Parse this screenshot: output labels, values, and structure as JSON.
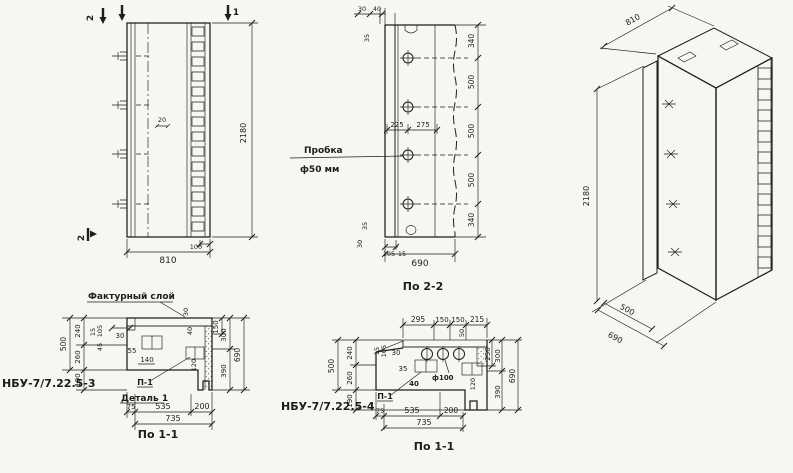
{
  "canvas": {
    "bg": "#f7f6f1",
    "ink": "#1d1d1d"
  },
  "elevation": {
    "mark_top_left": "2",
    "mark_top_right": "1",
    "mark_bottom_left": "2",
    "dim_hook": "20",
    "dim_height": "2180",
    "dim_strip": "100",
    "dim_width": "810"
  },
  "section22": {
    "top_small_a": "30",
    "top_small_b": "40",
    "top_left_small": "35",
    "note_line1": "Пробка",
    "note_line2": "ф50 мм",
    "mid_left": "225",
    "mid_right": "275",
    "v_chain": [
      "340",
      "500",
      "500",
      "500",
      "340"
    ],
    "bot_small_a": "35",
    "bot_small_b": "30",
    "bot_small_c": "105",
    "bot_small_d": "15",
    "dim_width": "690",
    "caption": "По 2-2"
  },
  "iso": {
    "dim_top": "810",
    "dim_height": "2180",
    "dim_bottom_inner": "500",
    "dim_bottom_outer": "690"
  },
  "planA": {
    "note_facing": "Фактурный слой",
    "part_label": "НБУ-7/7.22.5-3",
    "note_detail": "Деталь 1",
    "note_p1": "П-1",
    "left_outer": "500",
    "left_chain": [
      "240",
      "260",
      "190"
    ],
    "sm_a": "15",
    "sm_b": "105",
    "sm_c": "45",
    "sm_d": "30",
    "sm_e": "55",
    "sm_f": "140",
    "tr_a": "30",
    "tr_b": "40",
    "right_inner": "150",
    "right_mid_a": "300",
    "right_mid_b": "390",
    "right_outer": "690",
    "sm_g": "120",
    "bottom_chain": [
      "75",
      "535",
      "200"
    ],
    "bottom_total": "735",
    "caption": "По 1-1"
  },
  "planB": {
    "part_label": "НБУ-7/7.22.5-4",
    "top_chain": [
      "295",
      "150",
      "150",
      "215"
    ],
    "sm_50": "50",
    "note_hole": "ф100",
    "note_p1": "П-1",
    "left_outer": "500",
    "left_chain": [
      "240",
      "260",
      "190"
    ],
    "sm_a": "15",
    "sm_b": "105",
    "sm_c": "30",
    "sm_d": "35",
    "sm_e": "40",
    "sm_f": "120",
    "right_inner": "250",
    "right_mid_a": "300",
    "right_mid_b": "390",
    "right_outer": "690",
    "bottom_chain": [
      "75",
      "535",
      "200"
    ],
    "bottom_total": "735",
    "caption": "По 1-1"
  }
}
